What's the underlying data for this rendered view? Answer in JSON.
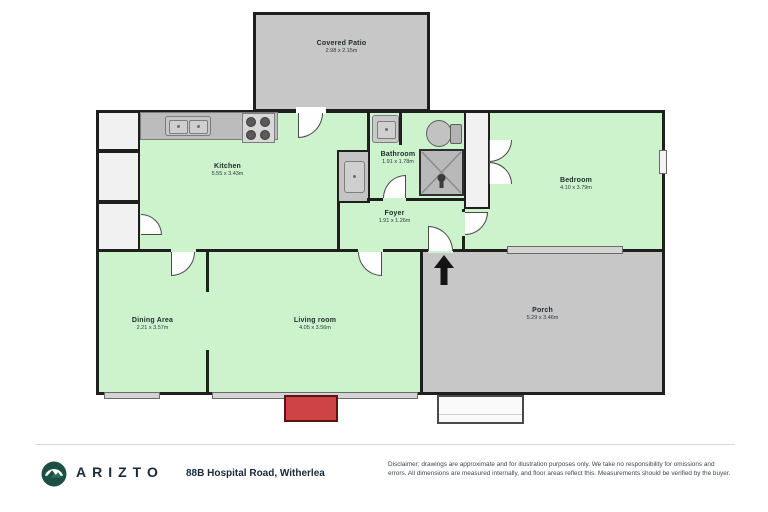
{
  "rooms": {
    "covered_patio": {
      "name": "Covered Patio",
      "dims": "2.98 x 2.15m"
    },
    "kitchen": {
      "name": "Kitchen",
      "dims": "5.55 x 3.43m"
    },
    "bathroom": {
      "name": "Bathroom",
      "dims": "1.91 x 1.78m"
    },
    "foyer": {
      "name": "Foyer",
      "dims": "1.91 x 1.26m"
    },
    "bedroom": {
      "name": "Bedroom",
      "dims": "4.10 x 3.79m"
    },
    "dining": {
      "name": "Dining Area",
      "dims": "2.21 x 3.57m"
    },
    "living": {
      "name": "Living room",
      "dims": "4.05 x 3.56m"
    },
    "porch": {
      "name": "Porch",
      "dims": "5.29 x 3.46m"
    }
  },
  "footer": {
    "brand": "ARIZTO",
    "address": "88B Hospital Road, Witherlea",
    "disclaimer_line1": "Disclaimer; drawings are approximate and for illustration purposes only. We take no responsibility for omissions and errors.",
    "disclaimer_line2": "All dimensions are measured internally, and floor areas reflect this. Measurements should be verified by the buyer."
  },
  "colors": {
    "wall": "#1f1f1f",
    "room_green": "#cdf3cd",
    "patio_gray": "#c7c7c7",
    "counter_gray": "#bcbcbc",
    "step_red": "#ce4444",
    "brand_navy": "#17293b",
    "logo_teal": "#1d4e46"
  }
}
